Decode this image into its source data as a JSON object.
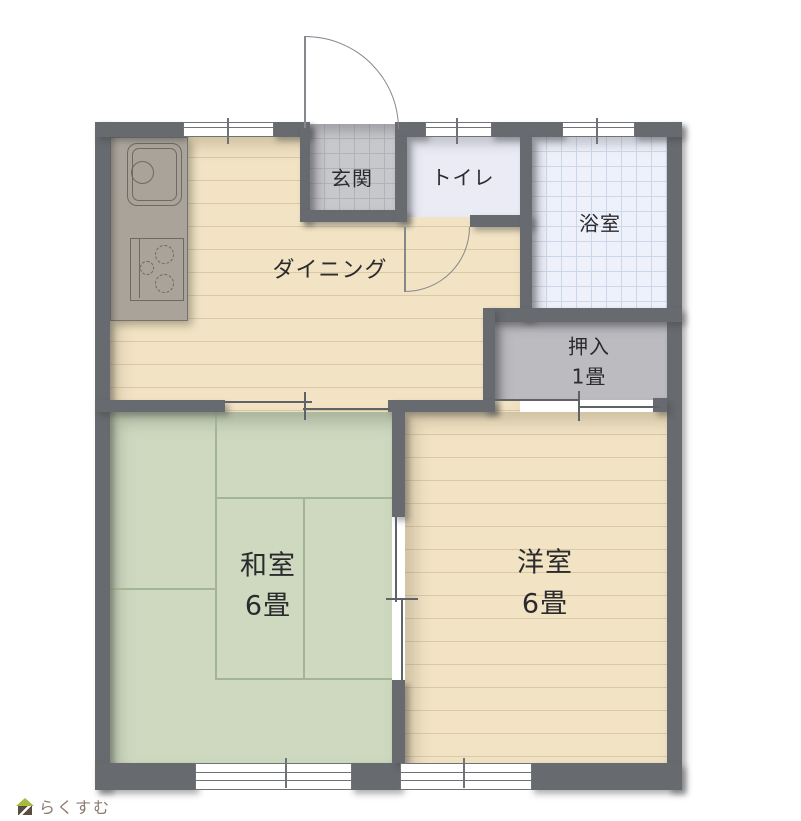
{
  "rooms": {
    "dining": {
      "label": "ダイニング"
    },
    "genkan": {
      "label": "玄関"
    },
    "toilet": {
      "label": "トイレ"
    },
    "bath": {
      "label": "浴室"
    },
    "closet": {
      "label": "押入",
      "size": "1畳"
    },
    "washitsu": {
      "label": "和室",
      "size": "6畳"
    },
    "youshitsu": {
      "label": "洋室",
      "size": "6畳"
    }
  },
  "logo": {
    "text": "らくすむ"
  },
  "colors": {
    "wall": "#676a6f",
    "wood_floor": "#f1e3c3",
    "wood_plank_line": "#d9c9a5",
    "tatami": "#ced9c0",
    "tatami_line": "#a3b694",
    "genkan_tile": "#c7c8cb",
    "bath_floor": "#eef1f9",
    "toilet_floor": "#eaebf4",
    "closet_floor": "#bcbcc0",
    "kitchen_counter": "#a9a399",
    "logo_roof": "#a3bc3c",
    "logo_body": "#5c4b42",
    "logo_text": "#8d7b70"
  }
}
